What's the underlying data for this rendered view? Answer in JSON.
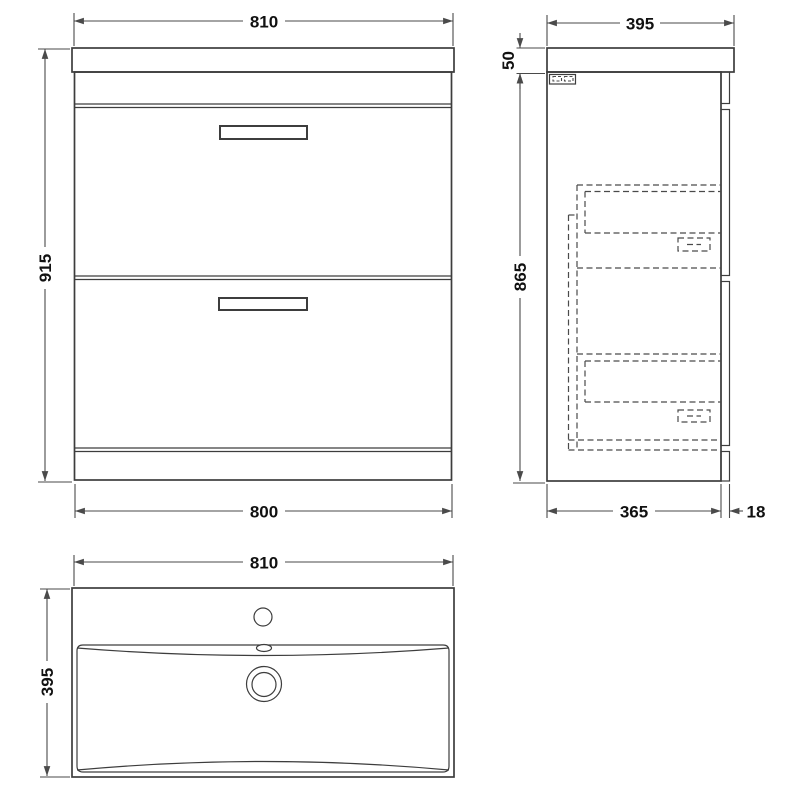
{
  "drawing": {
    "background": "#ffffff",
    "line_color": "#3d3d3d",
    "dim_color": "#4a4a4a",
    "text_color": "#111111",
    "views": {
      "front": {
        "label_width_top": "810",
        "label_height": "915",
        "label_width_bottom": "800"
      },
      "side": {
        "label_depth_top": "395",
        "label_worktop_thickness": "50",
        "label_cabinet_height": "865",
        "label_carcass_depth": "365",
        "label_front_thickness": "18"
      },
      "plan": {
        "label_basin_width": "810",
        "label_basin_depth": "395"
      }
    }
  }
}
